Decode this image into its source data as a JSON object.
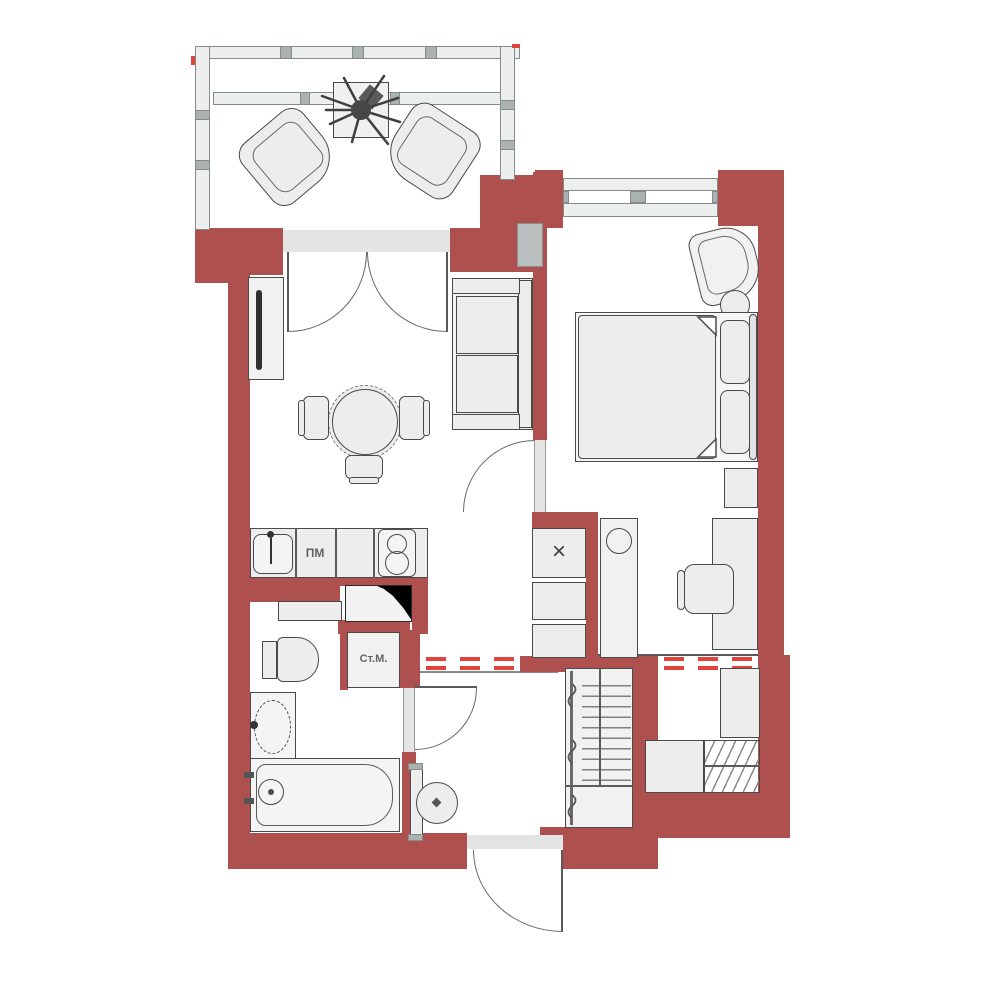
{
  "plan": {
    "labels": {
      "dishwasher": "ПМ",
      "washing_machine": "Ст.М.",
      "vent_shaft": "×"
    },
    "colors": {
      "wall": "#ad504e",
      "demolition_dash": "#e2443b",
      "furniture_outline": "#4a4a4a",
      "furniture_fill": "#ededed",
      "glazing_fill": "#edefef"
    },
    "furniture_icons": [
      "balcony-chair",
      "plant",
      "planter-table",
      "french-door",
      "tv-stand",
      "tv",
      "dining-table",
      "dining-chair",
      "sofa",
      "bed",
      "mattress",
      "pillow",
      "nightstand",
      "armchair",
      "side-table",
      "desk",
      "office-chair",
      "vent-shaft",
      "utility-cabinet",
      "kitchen-sink",
      "dishwasher",
      "stove",
      "fridge",
      "shelf",
      "washing-machine",
      "toilet",
      "washbasin",
      "bathtub",
      "boiler",
      "hall-wardrobe",
      "shoe-rack",
      "storage-unit",
      "entrance-door",
      "interior-door",
      "window",
      "demolition-line"
    ]
  }
}
